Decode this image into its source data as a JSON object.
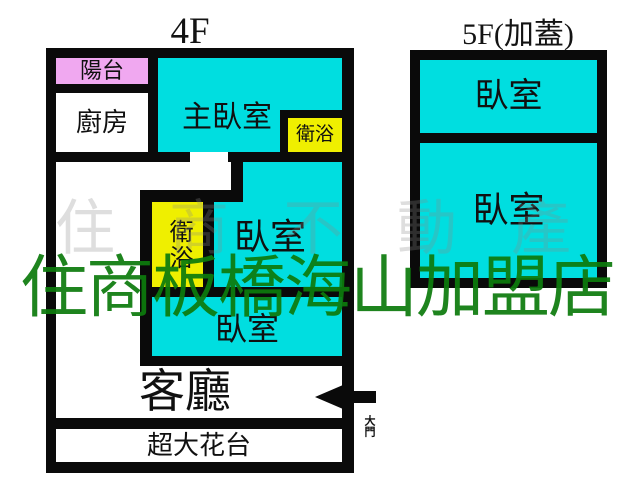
{
  "colors": {
    "cyan": "#00dee0",
    "yellow": "#efef00",
    "pink": "#f0a8f0",
    "wall": "#0a0a0a",
    "green": "#0d7b0d",
    "faint": "#8a8a8a"
  },
  "floor4": {
    "title": "4F",
    "rooms": {
      "balcony": "陽台",
      "kitchen": "廚房",
      "master_bedroom": "主臥室",
      "bathroom_upper": "衛浴",
      "bathroom_lower": "衛浴",
      "bedroom_middle": "臥室",
      "bedroom_lower": "臥室",
      "living_room": "客廳",
      "flower_terrace": "超大花台"
    },
    "door_label": "大門"
  },
  "floor5": {
    "title": "5F(加蓋)",
    "rooms": {
      "bedroom_upper": "臥室",
      "bedroom_lower": "臥室"
    }
  },
  "watermarks": {
    "green_text": "住商板橋海山加盟店",
    "faint_text": "住商不動產"
  }
}
